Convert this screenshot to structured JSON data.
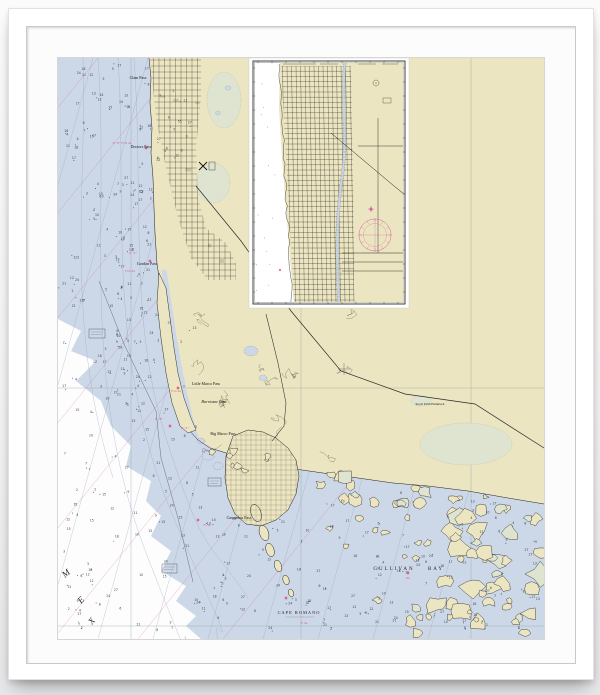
{
  "colors": {
    "land": "#ece5c1",
    "water": "#ccd8e8",
    "deep_water": "#fdfdfe",
    "marsh": "#dfe4d0",
    "marsh_edge": "#a5ad97",
    "magenta": "#d4619b",
    "coast": "#1c1c1c",
    "street_grid": "#24231f",
    "contour": "#8fa0b5",
    "graticule": "#9aa0a8",
    "sounding": "#3b4450",
    "road": "#2a2a2a",
    "mat": "#fcfcfd",
    "frame": "#ffffff"
  },
  "labels": {
    "passes": [
      {
        "text": "Clam Pass",
        "x": 80,
        "y": 21,
        "size": 4
      },
      {
        "text": "Doctors Pass",
        "x": 83,
        "y": 90,
        "size": 4
      },
      {
        "text": "Gordon Pass",
        "x": 89,
        "y": 207,
        "size": 4
      },
      {
        "text": "Little Marco Pass",
        "x": 148,
        "y": 327,
        "size": 4
      },
      {
        "text": "Hurricane Pass",
        "x": 156,
        "y": 345,
        "size": 4,
        "italic": true
      },
      {
        "text": "Big Marco Pass",
        "x": 165,
        "y": 377,
        "size": 4
      },
      {
        "text": "Caxambas Pass",
        "x": 181,
        "y": 461,
        "size": 4
      }
    ],
    "places": [
      {
        "text": "GULLIVAN",
        "x": 336,
        "y": 512,
        "size": 5,
        "ls": 2
      },
      {
        "text": "BAY",
        "x": 378,
        "y": 512,
        "size": 5,
        "ls": 2
      },
      {
        "text": "CAPE ROMANO",
        "x": 241,
        "y": 556,
        "size": 4.4,
        "ls": 1
      },
      {
        "text": "Royal Palm Hammock",
        "x": 372,
        "y": 347,
        "size": 3.2
      }
    ],
    "gulf_letters": [
      {
        "text": "M",
        "x": 7,
        "y": 520,
        "rot": -40
      },
      {
        "text": "E",
        "x": 23,
        "y": 546,
        "rot": -45
      },
      {
        "text": "X",
        "x": 34,
        "y": 567,
        "rot": -50
      }
    ],
    "pink_marks": [
      {
        "text": "R \"2\" Fl R 4s",
        "x": 64,
        "y": 86
      },
      {
        "text": "G \"1\"",
        "x": 75,
        "y": 196
      },
      {
        "text": "Fl R 4s",
        "x": 72,
        "y": 214
      },
      {
        "text": "Fl G 4s",
        "x": 118,
        "y": 334
      },
      {
        "text": "R \"8\"",
        "x": 101,
        "y": 362
      },
      {
        "text": "G \"1\"",
        "x": 127,
        "y": 371
      },
      {
        "text": "Fl 4s",
        "x": 149,
        "y": 468
      },
      {
        "text": "PA",
        "x": 350,
        "y": 521
      },
      {
        "text": "Fl 4s",
        "x": 246,
        "y": 566
      }
    ]
  },
  "soundings": {
    "values": [
      2,
      3,
      4,
      5,
      6,
      7,
      8,
      9,
      10,
      11,
      12,
      13,
      15,
      17,
      18,
      21,
      24,
      27
    ]
  }
}
